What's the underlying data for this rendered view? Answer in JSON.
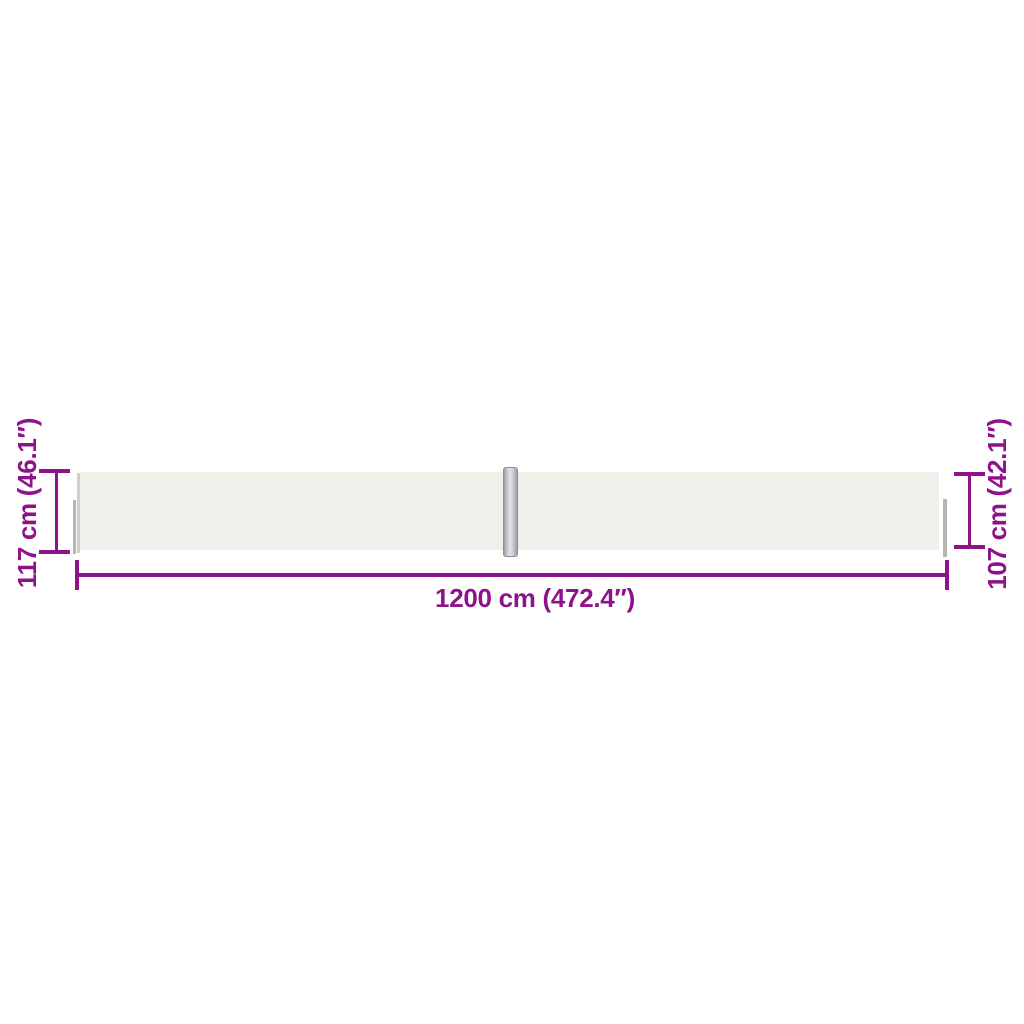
{
  "colors": {
    "accent": "#8e1289",
    "fabric": "#f0f0ea",
    "post_border": "#8b9199",
    "endcap": "#b6b6b3"
  },
  "dimensions": {
    "left_height": "117 cm (46.1″)",
    "right_height": "107 cm (42.1″)",
    "total_width": "1200 cm (472.4″)"
  }
}
